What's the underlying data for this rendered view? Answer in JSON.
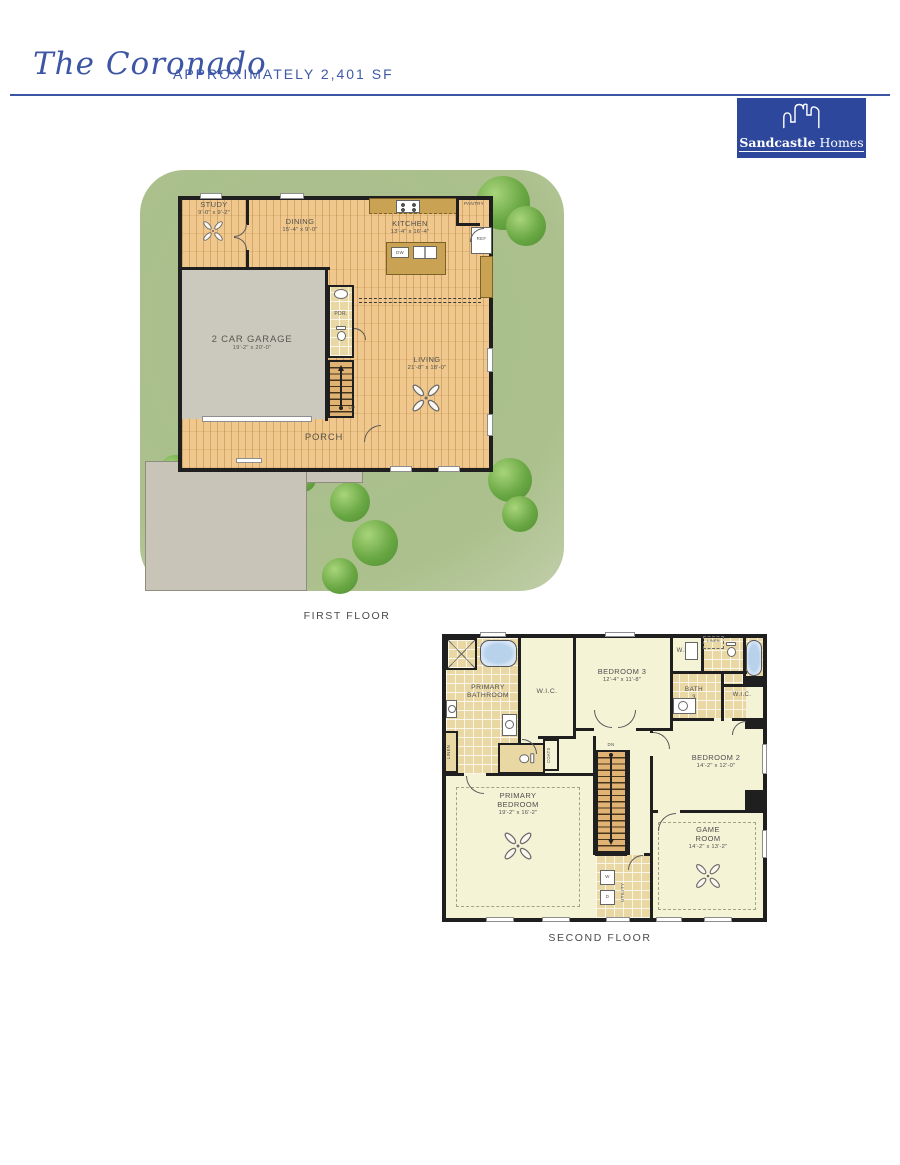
{
  "header": {
    "plan_name": "The Coronado",
    "approx_sf": "APPROXIMATELY 2,401 SF"
  },
  "logo": {
    "brand_bold": "Sandcastle",
    "brand_regular": "Homes"
  },
  "colors": {
    "accent_blue": "#3c55a5",
    "logo_blue": "#2c479b",
    "lawn_green": "#abc08c",
    "wood_floor": "#f0c88d",
    "tile_floor": "#e9d7a4",
    "room_cream": "#f5f3d6",
    "garage_gray": "#c8c5b8",
    "wall_black": "#1f1f1f",
    "label_gray": "#4f4f4f"
  },
  "floor1": {
    "label": "FIRST FLOOR",
    "study": {
      "name": "STUDY",
      "dims": "9'-0\" x 9'-2\""
    },
    "dining": {
      "name": "DINING",
      "dims": "15'-4\" x 9'-0\""
    },
    "kitchen": {
      "name": "KITCHEN",
      "dims": "13'-4\" x 16'-4\""
    },
    "pantry": "PANTRY",
    "ref": "REF",
    "dw": "DW",
    "garage": {
      "name": "2 CAR GARAGE",
      "dims": "19'-2\" x 20'-0\""
    },
    "pdr": "PDR.",
    "up": "UP",
    "living": {
      "name": "LIVING",
      "dims": "21'-8\" x 18'-0\""
    },
    "porch": "PORCH"
  },
  "floor2": {
    "label": "SECOND FLOOR",
    "primary_bath": {
      "line1": "PRIMARY",
      "line2": "BATHROOM"
    },
    "wic": "W.I.C.",
    "linen": "LINEN",
    "bedroom3": {
      "name": "BEDROOM 3",
      "dims": "12'-4\" x 11'-8\""
    },
    "bath3": {
      "line1": "BATH",
      "line2": "3"
    },
    "bedroom2": {
      "name": "BEDROOM 2",
      "dims": "14'-2\" x 12'-0\""
    },
    "coats": "COATS",
    "dn": "DN",
    "primary_bedroom": {
      "line1": "PRIMARY",
      "line2": "BEDROOM",
      "dims": "19'-2\" x 16'-2\""
    },
    "utility": "UTILITY",
    "washer": "W",
    "dryer": "D",
    "game": {
      "line1": "GAME",
      "line2": "ROOM",
      "dims": "14'-2\" x 13'-2\""
    }
  }
}
